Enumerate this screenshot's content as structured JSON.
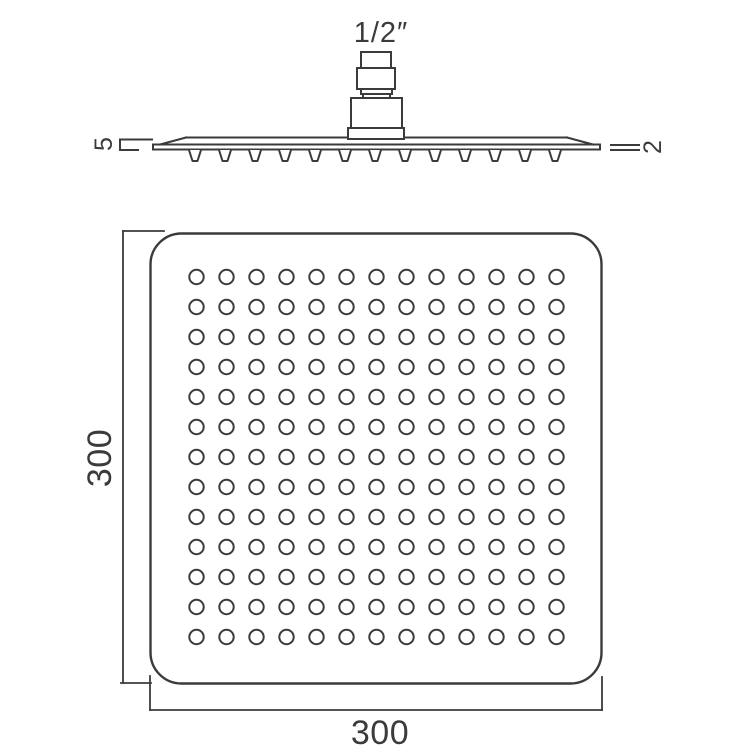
{
  "drawing": {
    "connector": {
      "size_label": "1/2″"
    },
    "side_profile": {
      "left_thickness_label": "5",
      "right_thickness_label": "2",
      "nozzle_count": 13
    },
    "face_view": {
      "height_label": "300",
      "width_label": "300",
      "hole_rows": 13,
      "hole_cols": 13
    },
    "colors": {
      "line": "#3b3b3b",
      "background": "#ffffff"
    }
  }
}
